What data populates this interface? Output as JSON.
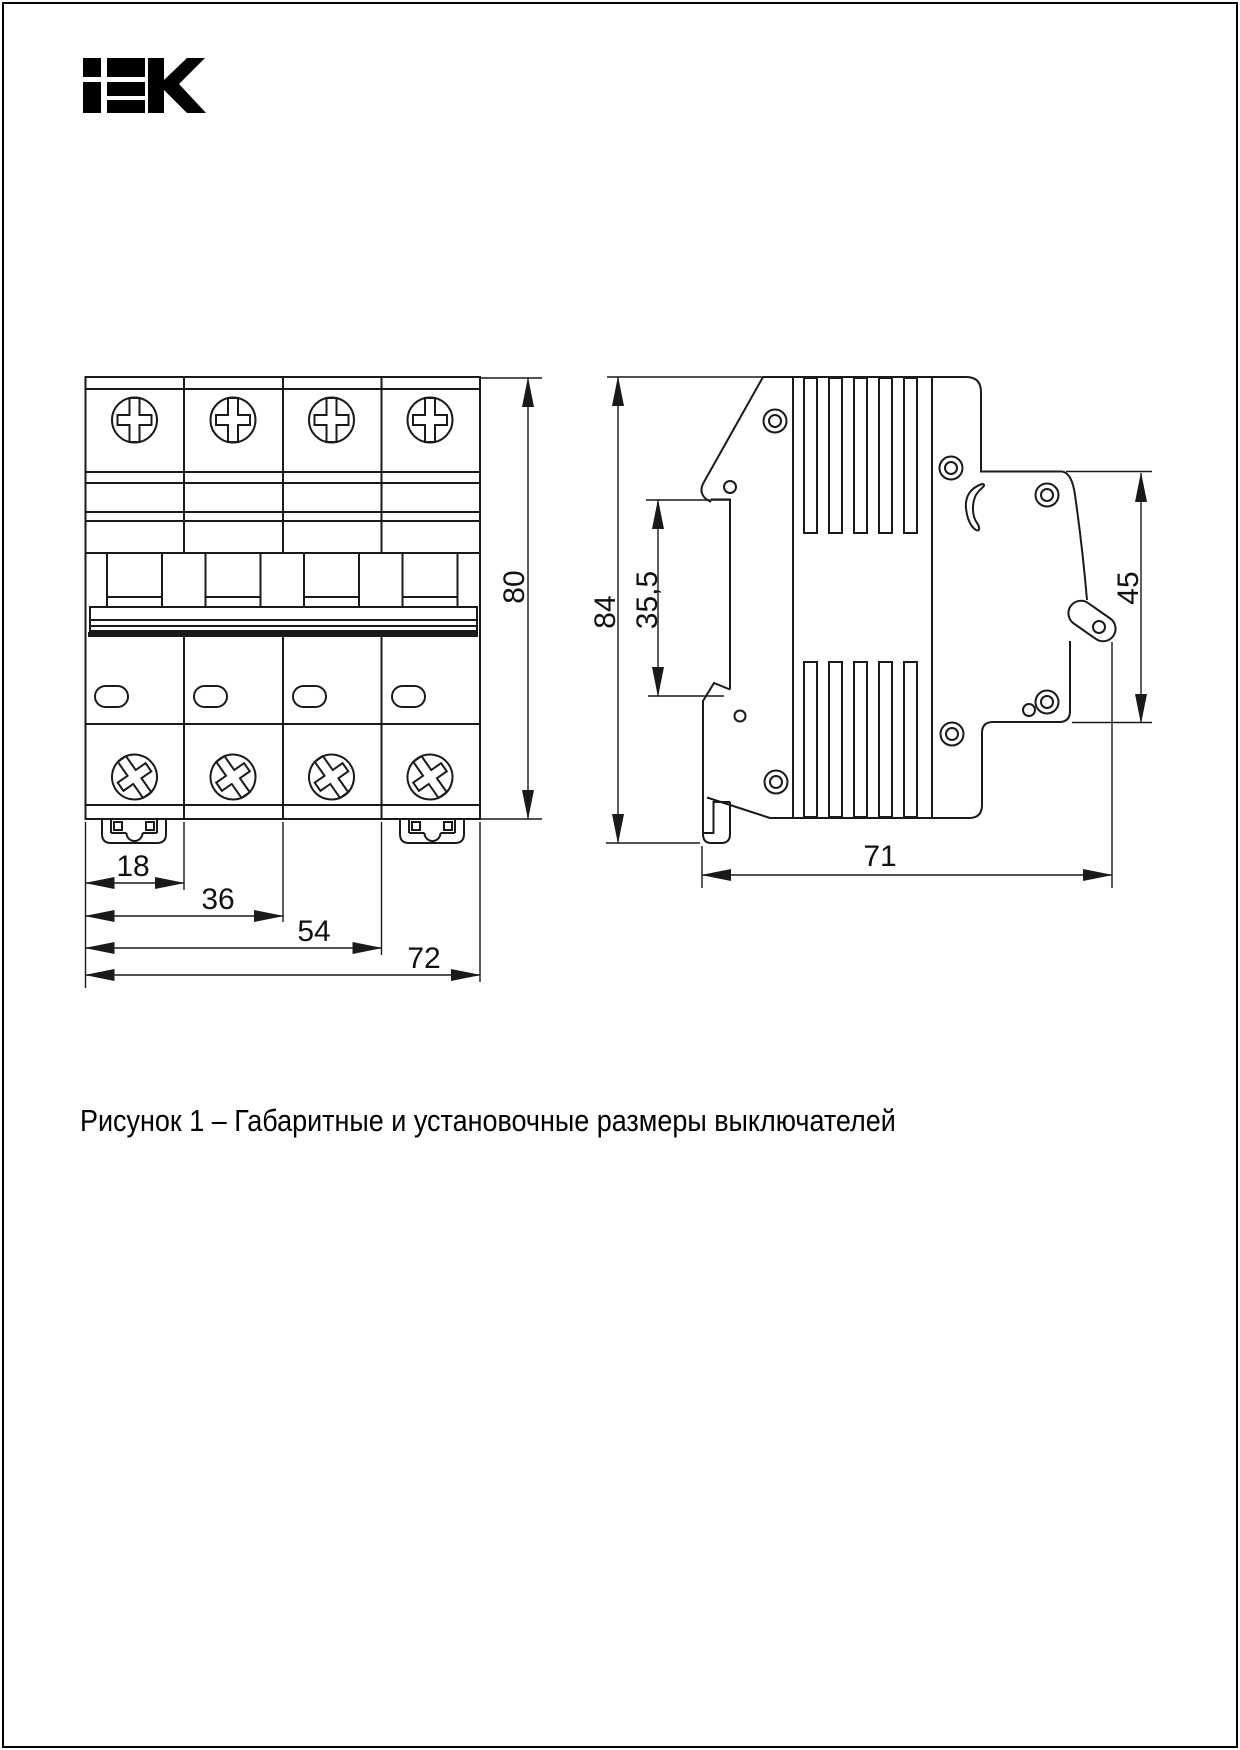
{
  "page": {
    "background": "#ffffff",
    "border_color": "#000000"
  },
  "logo": {
    "text": "IEK"
  },
  "figure": {
    "caption": "Рисунок 1 – Габаритные и установочные размеры выключателей"
  },
  "drawing": {
    "line_color": "#1a1a1a",
    "front_view": {
      "label": "front view of 4-pole modular circuit breaker",
      "dims": {
        "module": "18",
        "two_modules": "36",
        "three_modules": "54",
        "width": "72",
        "height": "80"
      }
    },
    "side_view": {
      "label": "side view of modular circuit breaker",
      "dims": {
        "height": "84",
        "rail_recess": "35,5",
        "front_height": "45",
        "depth": "71"
      }
    }
  }
}
